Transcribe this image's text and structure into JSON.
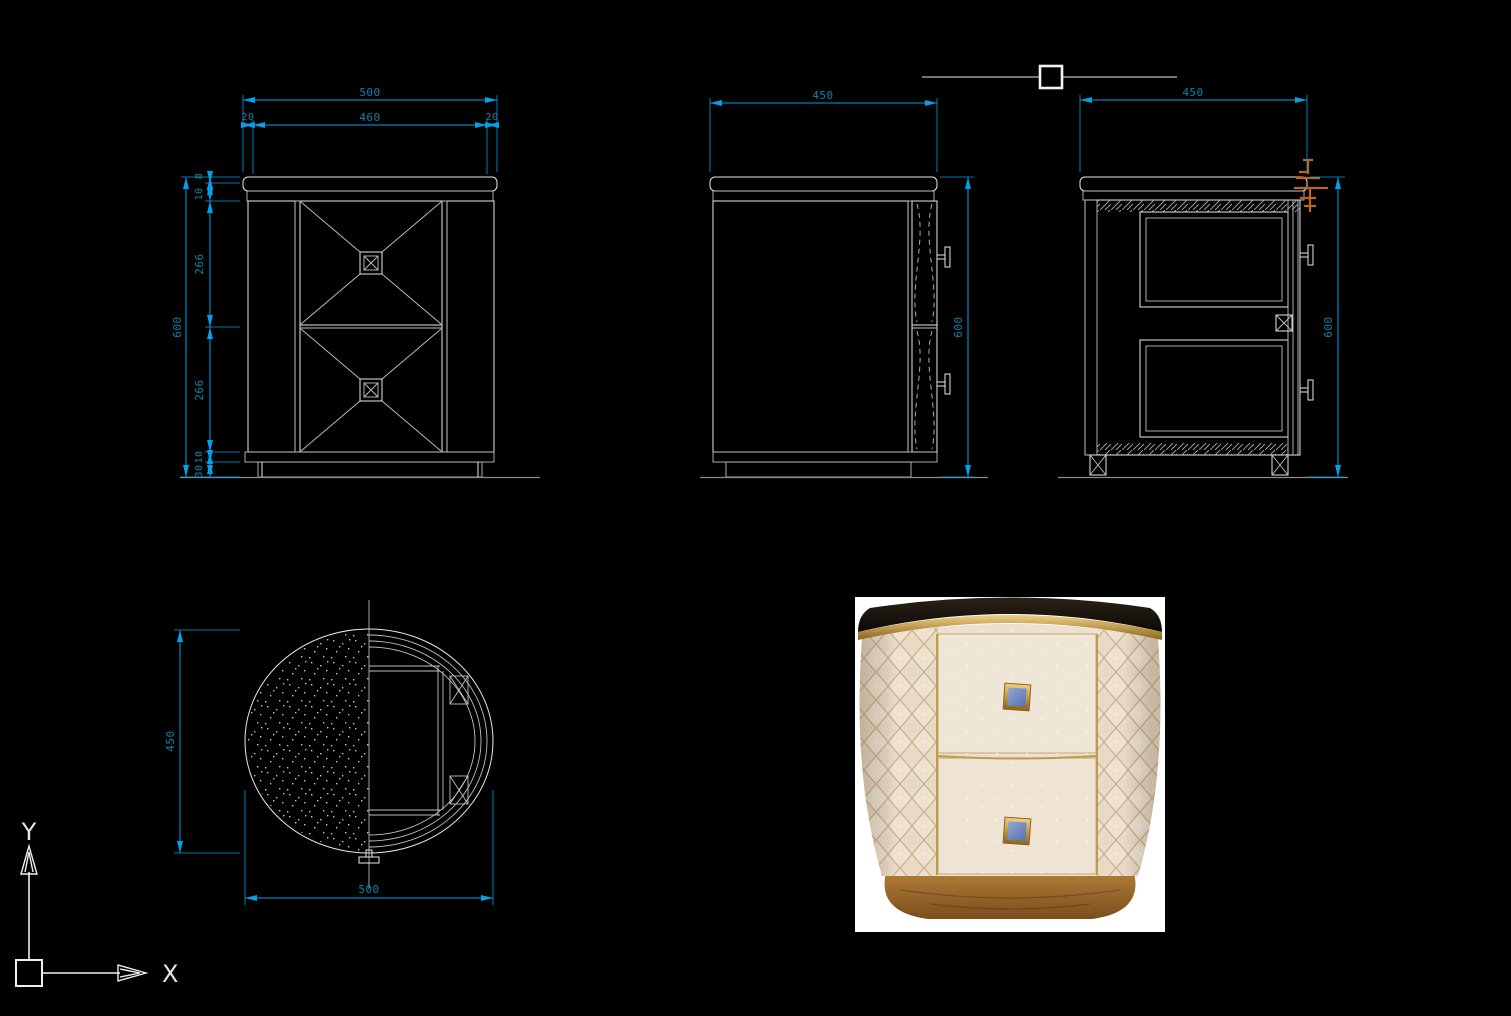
{
  "colors": {
    "background": "#000000",
    "drawing_line": "#e8e8e8",
    "dimension_line": "#00a2e8",
    "dimension_text": "#0a85a8",
    "annotation_orange": "#c2641a",
    "photo_cream": "#ece0cf",
    "photo_gold": "#bf9a4f",
    "photo_handle_blue": "#7288c0",
    "photo_wood_base": "#9a672c",
    "photo_marble_top": "#17110c"
  },
  "views": {
    "front": {
      "dims": {
        "overall_width": "500",
        "top_width": "460",
        "edge_left": "20",
        "edge_right": "20",
        "overall_height": "600",
        "top_edge": "8",
        "top_panel": "10",
        "upper_drawer": "266",
        "lower_drawer": "266",
        "bottom_rail": "10",
        "plinth": "30"
      }
    },
    "side": {
      "dims": {
        "width": "450",
        "height": "600"
      }
    },
    "section": {
      "dims": {
        "width": "450",
        "height": "600"
      }
    },
    "plan": {
      "dims": {
        "depth": "450",
        "width": "500"
      }
    }
  },
  "ucs": {
    "x_label": "X",
    "y_label": "Y"
  }
}
